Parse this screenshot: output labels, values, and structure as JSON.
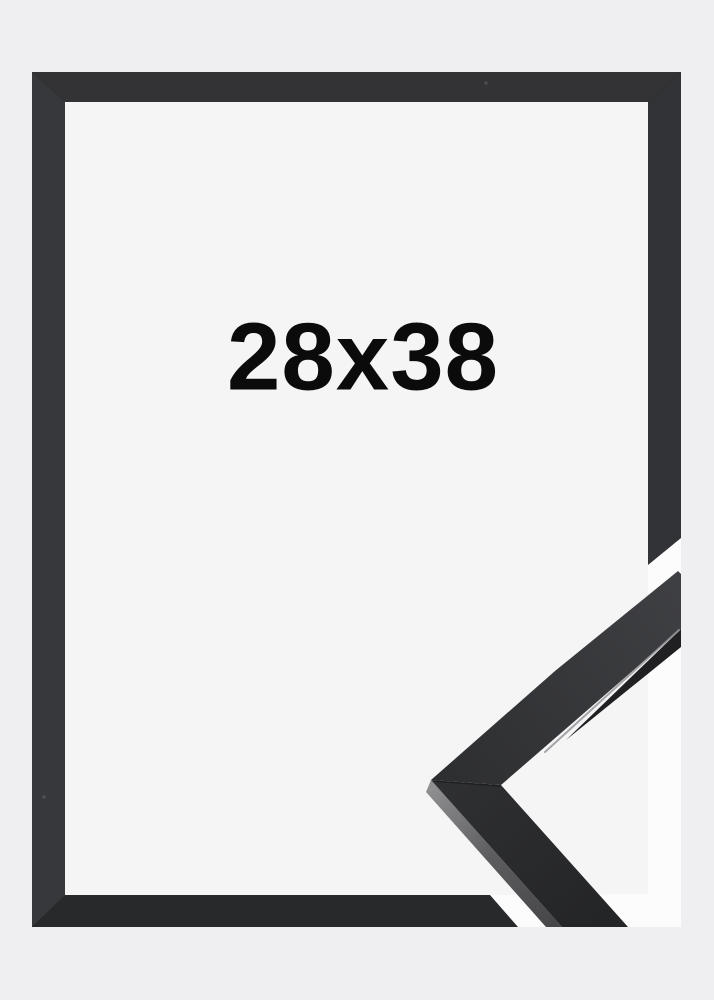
{
  "product": {
    "size_label": "28x38"
  },
  "colors": {
    "bg_outer": "#efeff1",
    "bg_inner": "#f5f5f6",
    "backdrop_white": "#fcfcfd",
    "frame_top": "#333336",
    "frame_right": "#323337",
    "frame_bottom": "#28292b",
    "frame_left": "#37383b",
    "sample_face_apex": "#2d2e30",
    "sample_face_tip": "#3e3f42",
    "sample_lower_top": "#2e2f31",
    "sample_lower_bottom": "#242527",
    "sample_side_light": "#8f8f91",
    "sample_side_mid": "#5d5d5f",
    "sample_side_dark": "#474749",
    "sample_inner_edge": "#202022",
    "sample_highlight": "#97979c",
    "text": "#0b0b0c"
  }
}
